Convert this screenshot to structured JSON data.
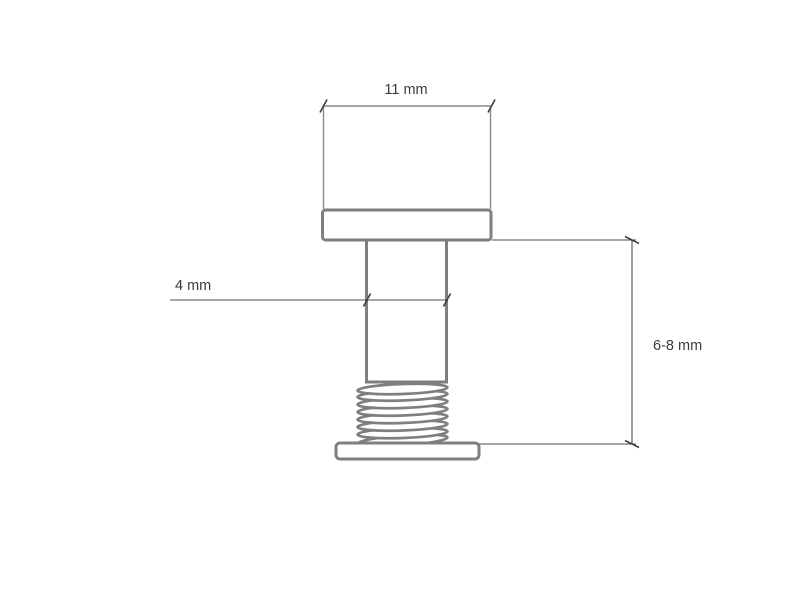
{
  "labels": {
    "head_width": "11 mm",
    "shaft_diameter": "4 mm",
    "post_length": "6-8 mm"
  },
  "colors": {
    "background": "#ffffff",
    "part_outline": "#7f7f7f",
    "dimension_line": "#4d4d4d",
    "label_text": "#3a3a3a"
  }
}
